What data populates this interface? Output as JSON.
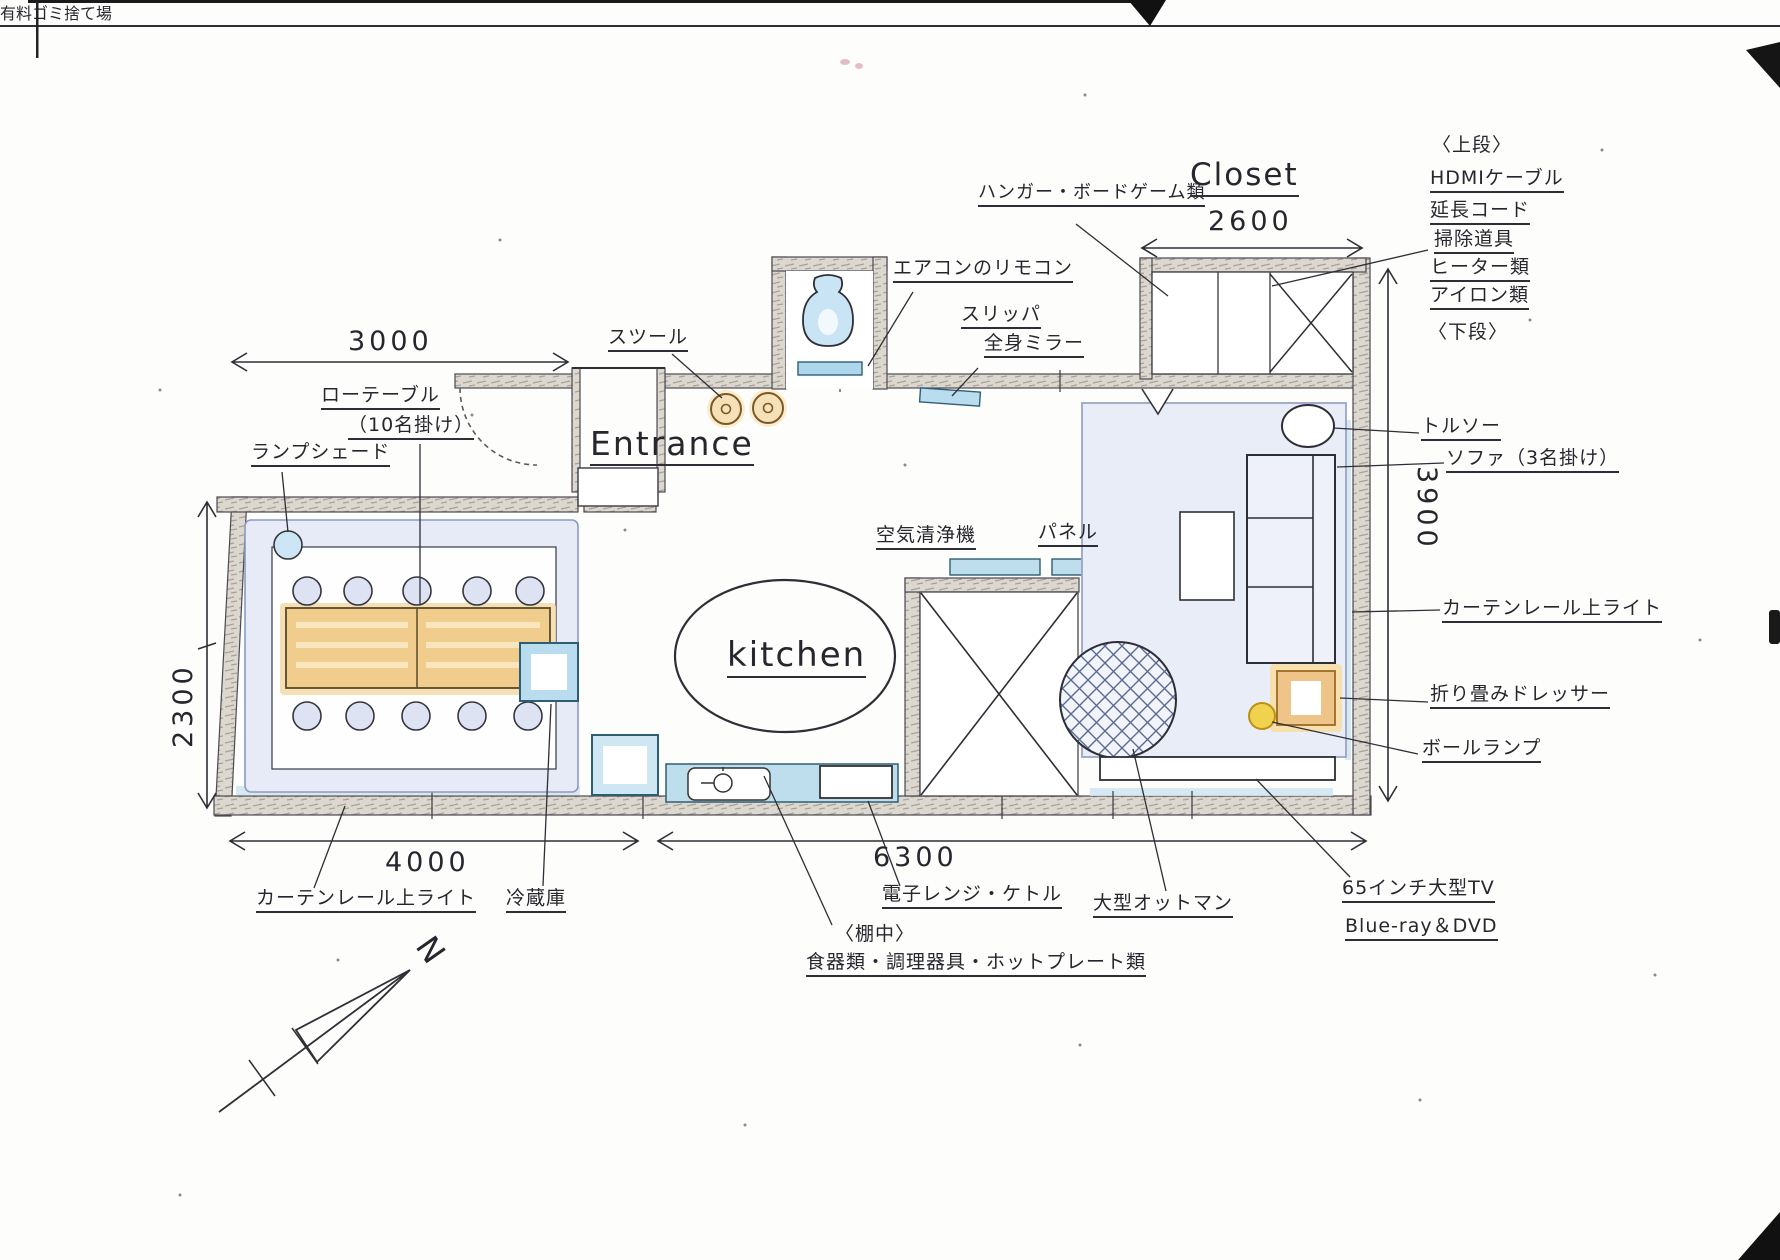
{
  "plan": {
    "rooms": {
      "entrance": "Entrance",
      "kitchen": "kitchen",
      "closet": "Closet"
    },
    "compass": "N",
    "dimensions": {
      "top_left": "3000",
      "left": "2300",
      "bottom_left": "4000",
      "bottom_right": "6300",
      "right": "3900",
      "closet": "2600"
    },
    "labels": {
      "hanger": "ハンガー・ボードゲーム類",
      "upper_header": "〈上段〉",
      "hdmi": "HDMIケーブル",
      "ext_cord": "延長コード",
      "cleaning": "掃除道具",
      "heater": "ヒーター類",
      "iron": "アイロン類",
      "lower_header": "〈下段〉",
      "trash": "有料ゴミ捨て場",
      "torso": "トルソー",
      "sofa": "ソファ（3名掛け）",
      "curtain_right": "カーテンレール上ライト",
      "dresser": "折り畳みドレッサー",
      "ball_lamp": "ボールランプ",
      "tv": "65インチ大型TV",
      "bluray": "Blue-ray＆DVD",
      "ottoman": "大型オットマン",
      "microwave": "電子レンジ・ケトル",
      "shelf_header": "〈棚中〉",
      "shelf_contents": "食器類・調理器具・ホットプレート類",
      "fridge": "冷蔵庫",
      "curtain_left": "カーテンレール上ライト",
      "stool": "スツール",
      "aircon_remote": "エアコンのリモコン",
      "slipper": "スリッパ",
      "mirror": "全身ミラー",
      "air_purifier": "空気清浄機",
      "panel": "パネル",
      "lampshade": "ランプシェード",
      "low_table": "ローテーブル",
      "low_table_sub": "（10名掛け）"
    },
    "palette": {
      "ink": "#26262e",
      "wall": "#dcd8d0",
      "rug_blue": "#e6ebf7",
      "water_blue": "#bfdeed",
      "wood": "#f0cc8d",
      "glow_orange": "#f6e0b8",
      "lamp_yellow": "#f1d24f"
    }
  }
}
